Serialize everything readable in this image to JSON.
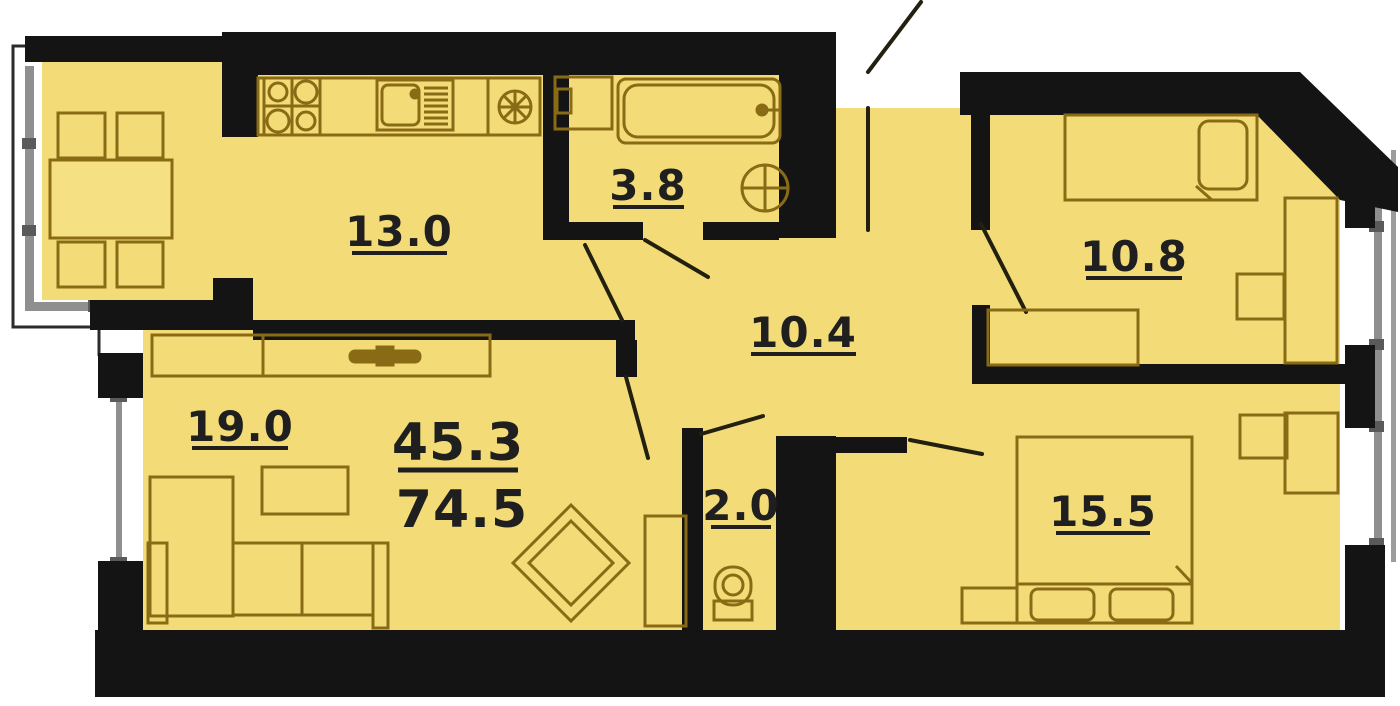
{
  "plan": {
    "type": "apartment-floor-plan",
    "rooms": {
      "kitchen": {
        "name": "kitchen-dining",
        "area": "13.0"
      },
      "bathroom": {
        "name": "bathroom",
        "area": "3.8"
      },
      "hallway": {
        "name": "hallway",
        "area": "10.4"
      },
      "bedroom1": {
        "name": "bedroom-top-right",
        "area": "10.8"
      },
      "living": {
        "name": "living-room",
        "area": "19.0"
      },
      "wc": {
        "name": "wc",
        "area": "2.0"
      },
      "bedroom2": {
        "name": "bedroom-bottom-right",
        "area": "15.5"
      }
    },
    "totals": {
      "living_area": "45.3",
      "total_area": "74.5"
    },
    "colors": {
      "floor": "#F3DC78",
      "wall": "#141414",
      "furniture_line": "#8A6B15",
      "door_line": "#23200F",
      "glazing": "#8F8F8F",
      "label_text": "#1F1F1F",
      "background": "#FFFFFF"
    }
  }
}
